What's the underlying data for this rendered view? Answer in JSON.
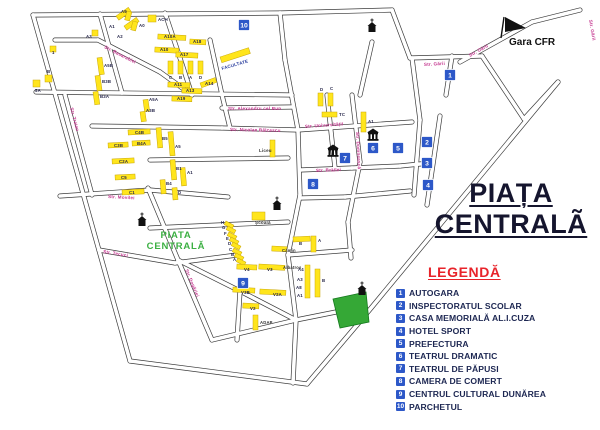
{
  "title": {
    "line1": "PIAȚA",
    "line2": "CENTRALÃ"
  },
  "map_label": {
    "line1": "PIATA",
    "line2": "CENTRALĂ"
  },
  "gara": {
    "label": "Gara CFR"
  },
  "legend": {
    "title": "LEGENDĂ",
    "items": [
      {
        "num": "1",
        "label": "AUTOGARA"
      },
      {
        "num": "2",
        "label": "INSPECTORATUL SCOLAR"
      },
      {
        "num": "3",
        "label": "CASA MEMORIALĂ AL.I.CUZA"
      },
      {
        "num": "4",
        "label": "HOTEL SPORT"
      },
      {
        "num": "5",
        "label": "PREFECTURA"
      },
      {
        "num": "6",
        "label": "TEATRUL DRAMATIC"
      },
      {
        "num": "7",
        "label": "TEATRUL DE PĂPUSI"
      },
      {
        "num": "8",
        "label": "CAMERA DE COMERT"
      },
      {
        "num": "9",
        "label": "CENTRUL CULTURAL DUNĂREA"
      },
      {
        "num": "10",
        "label": "PARCHETUL"
      }
    ]
  },
  "colors": {
    "street": "#3b3b3b",
    "street_fill": "#ffffff",
    "street_label": "#c4348e",
    "building": "#ffe51c",
    "building_stroke": "#c9a70a",
    "building_label": "#26264a",
    "marker_bg": "#2d58c8",
    "park": "#35a836",
    "park_stroke": "#157a1e",
    "map_label_green": "#3cb043",
    "icon_black": "#111111"
  },
  "map": {
    "streets": [
      [
        33,
        15,
        280,
        13
      ],
      [
        280,
        13,
        392,
        10
      ],
      [
        33,
        15,
        130,
        361
      ],
      [
        130,
        361,
        307,
        384
      ],
      [
        307,
        384,
        357,
        325
      ],
      [
        357,
        325,
        558,
        82
      ],
      [
        392,
        10,
        410,
        58
      ],
      [
        410,
        58,
        482,
        56
      ],
      [
        482,
        56,
        524,
        119
      ],
      [
        524,
        119,
        558,
        82
      ],
      [
        460,
        62,
        532,
        22
      ],
      [
        532,
        22,
        580,
        10
      ],
      [
        100,
        14,
        122,
        93
      ],
      [
        165,
        13,
        180,
        58
      ],
      [
        180,
        58,
        192,
        95
      ],
      [
        210,
        40,
        222,
        95
      ],
      [
        280,
        13,
        285,
        60
      ],
      [
        372,
        42,
        360,
        95
      ],
      [
        98,
        40,
        160,
        72
      ],
      [
        160,
        72,
        192,
        95
      ],
      [
        55,
        40,
        98,
        40
      ],
      [
        65,
        95,
        92,
        195
      ],
      [
        36,
        92,
        292,
        95
      ],
      [
        92,
        126,
        222,
        128
      ],
      [
        222,
        128,
        298,
        130
      ],
      [
        222,
        108,
        292,
        107
      ],
      [
        298,
        130,
        412,
        122
      ],
      [
        150,
        160,
        288,
        158
      ],
      [
        60,
        196,
        150,
        190
      ],
      [
        150,
        190,
        228,
        197
      ],
      [
        99,
        250,
        175,
        263
      ],
      [
        175,
        263,
        237,
        255
      ],
      [
        150,
        228,
        288,
        222
      ],
      [
        288,
        255,
        352,
        250
      ],
      [
        296,
        320,
        336,
        312
      ],
      [
        300,
        198,
        345,
        197
      ],
      [
        345,
        197,
        410,
        191
      ],
      [
        300,
        170,
        352,
        168
      ],
      [
        352,
        168,
        400,
        166
      ],
      [
        400,
        166,
        430,
        163
      ],
      [
        285,
        60,
        298,
        130
      ],
      [
        298,
        130,
        300,
        195
      ],
      [
        300,
        195,
        288,
        255
      ],
      [
        288,
        255,
        296,
        320
      ],
      [
        296,
        320,
        293,
        383
      ],
      [
        327,
        95,
        335,
        168
      ],
      [
        352,
        95,
        360,
        162
      ],
      [
        360,
        162,
        348,
        222
      ],
      [
        348,
        222,
        351,
        258
      ],
      [
        412,
        58,
        420,
        120
      ],
      [
        420,
        120,
        414,
        195
      ],
      [
        440,
        116,
        427,
        205
      ],
      [
        452,
        56,
        446,
        95
      ],
      [
        148,
        188,
        178,
        260
      ],
      [
        178,
        260,
        212,
        340
      ],
      [
        212,
        340,
        296,
        320
      ],
      [
        178,
        260,
        240,
        291
      ],
      [
        240,
        291,
        296,
        320
      ],
      [
        240,
        291,
        237,
        340
      ],
      [
        222,
        95,
        230,
        128
      ]
    ],
    "street_labels": [
      {
        "t": "Str. Basarabiei",
        "x": 104,
        "y": 48,
        "r": 27
      },
      {
        "t": "Str. Traian",
        "x": 70,
        "y": 108,
        "r": 75
      },
      {
        "t": "Str. Movilei",
        "x": 108,
        "y": 198,
        "r": 3
      },
      {
        "t": "Str. Tecuci",
        "x": 103,
        "y": 253,
        "r": 9
      },
      {
        "t": "Str. Dogăriei",
        "x": 185,
        "y": 270,
        "r": 67
      },
      {
        "t": "Str. Alexandru cel Bun",
        "x": 228,
        "y": 110,
        "r": 0
      },
      {
        "t": "Str. Nicolae Bălcescu",
        "x": 230,
        "y": 131,
        "r": 1
      },
      {
        "t": "Str. Universității",
        "x": 305,
        "y": 128,
        "r": -4
      },
      {
        "t": "Str. Brăilei",
        "x": 316,
        "y": 172,
        "r": -2
      },
      {
        "t": "Str. Domnească",
        "x": 356,
        "y": 132,
        "r": 87
      },
      {
        "t": "Str. Gării",
        "x": 424,
        "y": 66,
        "r": -3
      },
      {
        "t": "Str. Gării",
        "x": 470,
        "y": 57,
        "r": -29
      },
      {
        "t": "Str. Gării",
        "x": 589,
        "y": 20,
        "r": 80
      }
    ],
    "buildings": [
      [
        116,
        16,
        15,
        5,
        -35
      ],
      [
        124,
        26,
        15,
        5,
        -35
      ],
      [
        148,
        15,
        8,
        7,
        0
      ],
      [
        127,
        11,
        5,
        9,
        15
      ],
      [
        133,
        21,
        5,
        9,
        15
      ],
      [
        92,
        30,
        6,
        6,
        0
      ],
      [
        33,
        80,
        7,
        7,
        0
      ],
      [
        45,
        75,
        7,
        7,
        0
      ],
      [
        50,
        46,
        6,
        6,
        0
      ],
      [
        158,
        34,
        28,
        5,
        3
      ],
      [
        190,
        39,
        16,
        5,
        3
      ],
      [
        155,
        47,
        24,
        5,
        3
      ],
      [
        176,
        52,
        22,
        5,
        3
      ],
      [
        168,
        61,
        5,
        13,
        0
      ],
      [
        178,
        61,
        5,
        13,
        0
      ],
      [
        188,
        61,
        5,
        13,
        0
      ],
      [
        198,
        61,
        5,
        13,
        0
      ],
      [
        168,
        82,
        22,
        5,
        2
      ],
      [
        182,
        88,
        20,
        5,
        2
      ],
      [
        200,
        83,
        16,
        5,
        -20
      ],
      [
        172,
        96,
        20,
        5,
        2
      ],
      [
        97,
        58,
        5,
        17,
        -8
      ],
      [
        95,
        76,
        5,
        15,
        -8
      ],
      [
        93,
        92,
        5,
        13,
        -8
      ],
      [
        143,
        100,
        5,
        12,
        -8
      ],
      [
        140,
        112,
        5,
        10,
        -8
      ],
      [
        128,
        130,
        22,
        5,
        -3
      ],
      [
        108,
        143,
        20,
        5,
        -3
      ],
      [
        132,
        141,
        18,
        5,
        -3
      ],
      [
        112,
        159,
        22,
        5,
        -3
      ],
      [
        115,
        175,
        20,
        5,
        -3
      ],
      [
        122,
        190,
        22,
        5,
        -3
      ],
      [
        156,
        128,
        5,
        20,
        -5
      ],
      [
        168,
        132,
        5,
        24,
        -5
      ],
      [
        170,
        160,
        5,
        20,
        -5
      ],
      [
        160,
        180,
        5,
        14,
        -5
      ],
      [
        180,
        168,
        5,
        18,
        -5
      ],
      [
        172,
        188,
        5,
        12,
        -5
      ],
      [
        318,
        93,
        5,
        13,
        0
      ],
      [
        328,
        93,
        5,
        13,
        0
      ],
      [
        322,
        112,
        15,
        5,
        0
      ],
      [
        361,
        112,
        5,
        20,
        0
      ],
      [
        220,
        57,
        30,
        6,
        -18
      ],
      [
        270,
        140,
        5,
        17,
        0
      ],
      [
        252,
        212,
        13,
        8,
        0
      ],
      [
        226,
        221,
        9,
        4,
        28
      ],
      [
        228,
        226,
        9,
        4,
        28
      ],
      [
        229,
        232,
        9,
        4,
        28
      ],
      [
        231,
        237,
        9,
        4,
        28
      ],
      [
        233,
        242,
        9,
        4,
        28
      ],
      [
        234,
        248,
        9,
        4,
        28
      ],
      [
        236,
        253,
        9,
        4,
        28
      ],
      [
        238,
        258,
        9,
        4,
        28
      ],
      [
        237,
        264,
        20,
        5,
        3
      ],
      [
        259,
        264,
        26,
        5,
        3
      ],
      [
        272,
        246,
        15,
        5,
        3
      ],
      [
        233,
        287,
        22,
        5,
        3
      ],
      [
        260,
        289,
        26,
        5,
        3
      ],
      [
        243,
        303,
        16,
        5,
        3
      ],
      [
        253,
        315,
        5,
        15,
        0
      ],
      [
        293,
        237,
        17,
        5,
        -3
      ],
      [
        311,
        236,
        5,
        16,
        0
      ],
      [
        305,
        265,
        5,
        33,
        0
      ],
      [
        315,
        269,
        5,
        28,
        0
      ]
    ],
    "building_labels": [
      {
        "t": "A1",
        "x": 109,
        "y": 28
      },
      {
        "t": "A2",
        "x": 117,
        "y": 38
      },
      {
        "t": "ACH",
        "x": 158,
        "y": 21
      },
      {
        "t": "A9",
        "x": 121,
        "y": 13
      },
      {
        "t": "A0",
        "x": 139,
        "y": 27
      },
      {
        "t": "A3",
        "x": 86,
        "y": 38
      },
      {
        "t": "5A",
        "x": 35,
        "y": 92
      },
      {
        "t": "B",
        "x": 47,
        "y": 73
      },
      {
        "t": "1",
        "x": 52,
        "y": 54
      },
      {
        "t": "A10A",
        "x": 164,
        "y": 38
      },
      {
        "t": "A18",
        "x": 193,
        "y": 43
      },
      {
        "t": "A10",
        "x": 160,
        "y": 51
      },
      {
        "t": "A17",
        "x": 180,
        "y": 56
      },
      {
        "t": "C",
        "x": 169,
        "y": 79
      },
      {
        "t": "B",
        "x": 179,
        "y": 79
      },
      {
        "t": "A",
        "x": 189,
        "y": 79
      },
      {
        "t": "D",
        "x": 199,
        "y": 79
      },
      {
        "t": "A11",
        "x": 174,
        "y": 86
      },
      {
        "t": "A13",
        "x": 186,
        "y": 92
      },
      {
        "t": "A14",
        "x": 205,
        "y": 85
      },
      {
        "t": "A19",
        "x": 177,
        "y": 100
      },
      {
        "t": "A5B",
        "x": 104,
        "y": 67
      },
      {
        "t": "B3B",
        "x": 102,
        "y": 83
      },
      {
        "t": "B3A",
        "x": 100,
        "y": 98
      },
      {
        "t": "A5A",
        "x": 149,
        "y": 101
      },
      {
        "t": "A3B",
        "x": 146,
        "y": 112
      },
      {
        "t": "C4B",
        "x": 135,
        "y": 134
      },
      {
        "t": "C3B",
        "x": 114,
        "y": 147
      },
      {
        "t": "B4A",
        "x": 137,
        "y": 145
      },
      {
        "t": "C2A",
        "x": 119,
        "y": 163
      },
      {
        "t": "C5",
        "x": 121,
        "y": 179
      },
      {
        "t": "C1",
        "x": 129,
        "y": 194
      },
      {
        "t": "B5",
        "x": 162,
        "y": 140
      },
      {
        "t": "A5",
        "x": 175,
        "y": 148
      },
      {
        "t": "B1",
        "x": 176,
        "y": 170
      },
      {
        "t": "B4",
        "x": 166,
        "y": 185
      },
      {
        "t": "D",
        "x": 178,
        "y": 194
      },
      {
        "t": "A1",
        "x": 187,
        "y": 174
      },
      {
        "t": "D",
        "x": 320,
        "y": 91
      },
      {
        "t": "C",
        "x": 330,
        "y": 90
      },
      {
        "t": "TC",
        "x": 339,
        "y": 116
      },
      {
        "t": "A1",
        "x": 368,
        "y": 123
      },
      {
        "t": "H",
        "x": 221,
        "y": 224
      },
      {
        "t": "G",
        "x": 222,
        "y": 229
      },
      {
        "t": "F",
        "x": 224,
        "y": 235
      },
      {
        "t": "E",
        "x": 226,
        "y": 240
      },
      {
        "t": "D",
        "x": 228,
        "y": 245
      },
      {
        "t": "C",
        "x": 229,
        "y": 251
      },
      {
        "t": "B",
        "x": 231,
        "y": 256
      },
      {
        "t": "A",
        "x": 233,
        "y": 261
      },
      {
        "t": "V4",
        "x": 244,
        "y": 271
      },
      {
        "t": "V3",
        "x": 267,
        "y": 271
      },
      {
        "t": "V3B",
        "x": 241,
        "y": 294
      },
      {
        "t": "V2A",
        "x": 273,
        "y": 296
      },
      {
        "t": "V2",
        "x": 250,
        "y": 310
      },
      {
        "t": "B",
        "x": 299,
        "y": 245
      },
      {
        "t": "A",
        "x": 318,
        "y": 242
      },
      {
        "t": "A4",
        "x": 298,
        "y": 271
      },
      {
        "t": "A3",
        "x": 297,
        "y": 281
      },
      {
        "t": "A8",
        "x": 296,
        "y": 289
      },
      {
        "t": "A1",
        "x": 297,
        "y": 297
      },
      {
        "t": "B",
        "x": 322,
        "y": 282
      }
    ],
    "poi_labels": [
      {
        "t": "FACULTATE",
        "x": 222,
        "y": 70,
        "r": -16,
        "c": "#2b3f9e",
        "s": 4.5
      },
      {
        "t": "Școală",
        "x": 255,
        "y": 224,
        "r": 0,
        "c": "#333333",
        "s": 4.5
      },
      {
        "t": "Liceu",
        "x": 259,
        "y": 152,
        "r": 0,
        "c": "#333333",
        "s": 4.5
      },
      {
        "t": "Cămin",
        "x": 282,
        "y": 252,
        "r": 0,
        "c": "#333333",
        "s": 4.2
      },
      {
        "t": "Albatros",
        "x": 283,
        "y": 269,
        "r": 0,
        "c": "#333333",
        "s": 4.2
      },
      {
        "t": "ADAP",
        "x": 260,
        "y": 324,
        "r": 0,
        "c": "#333333",
        "s": 4.2
      }
    ],
    "markers": [
      {
        "n": "1",
        "x": 450,
        "y": 75
      },
      {
        "n": "2",
        "x": 427,
        "y": 142
      },
      {
        "n": "3",
        "x": 427,
        "y": 163
      },
      {
        "n": "4",
        "x": 428,
        "y": 185
      },
      {
        "n": "5",
        "x": 398,
        "y": 148
      },
      {
        "n": "6",
        "x": 373,
        "y": 148
      },
      {
        "n": "7",
        "x": 345,
        "y": 158
      },
      {
        "n": "8",
        "x": 313,
        "y": 184
      },
      {
        "n": "9",
        "x": 243,
        "y": 283
      },
      {
        "n": "10",
        "x": 244,
        "y": 25
      }
    ],
    "churches": [
      [
        372,
        32
      ],
      [
        142,
        226
      ],
      [
        277,
        210
      ],
      [
        362,
        295
      ]
    ],
    "theaters": [
      [
        373,
        136
      ],
      [
        333,
        152
      ]
    ],
    "park": {
      "points": "333,299 366,292 369,322 340,328"
    }
  }
}
